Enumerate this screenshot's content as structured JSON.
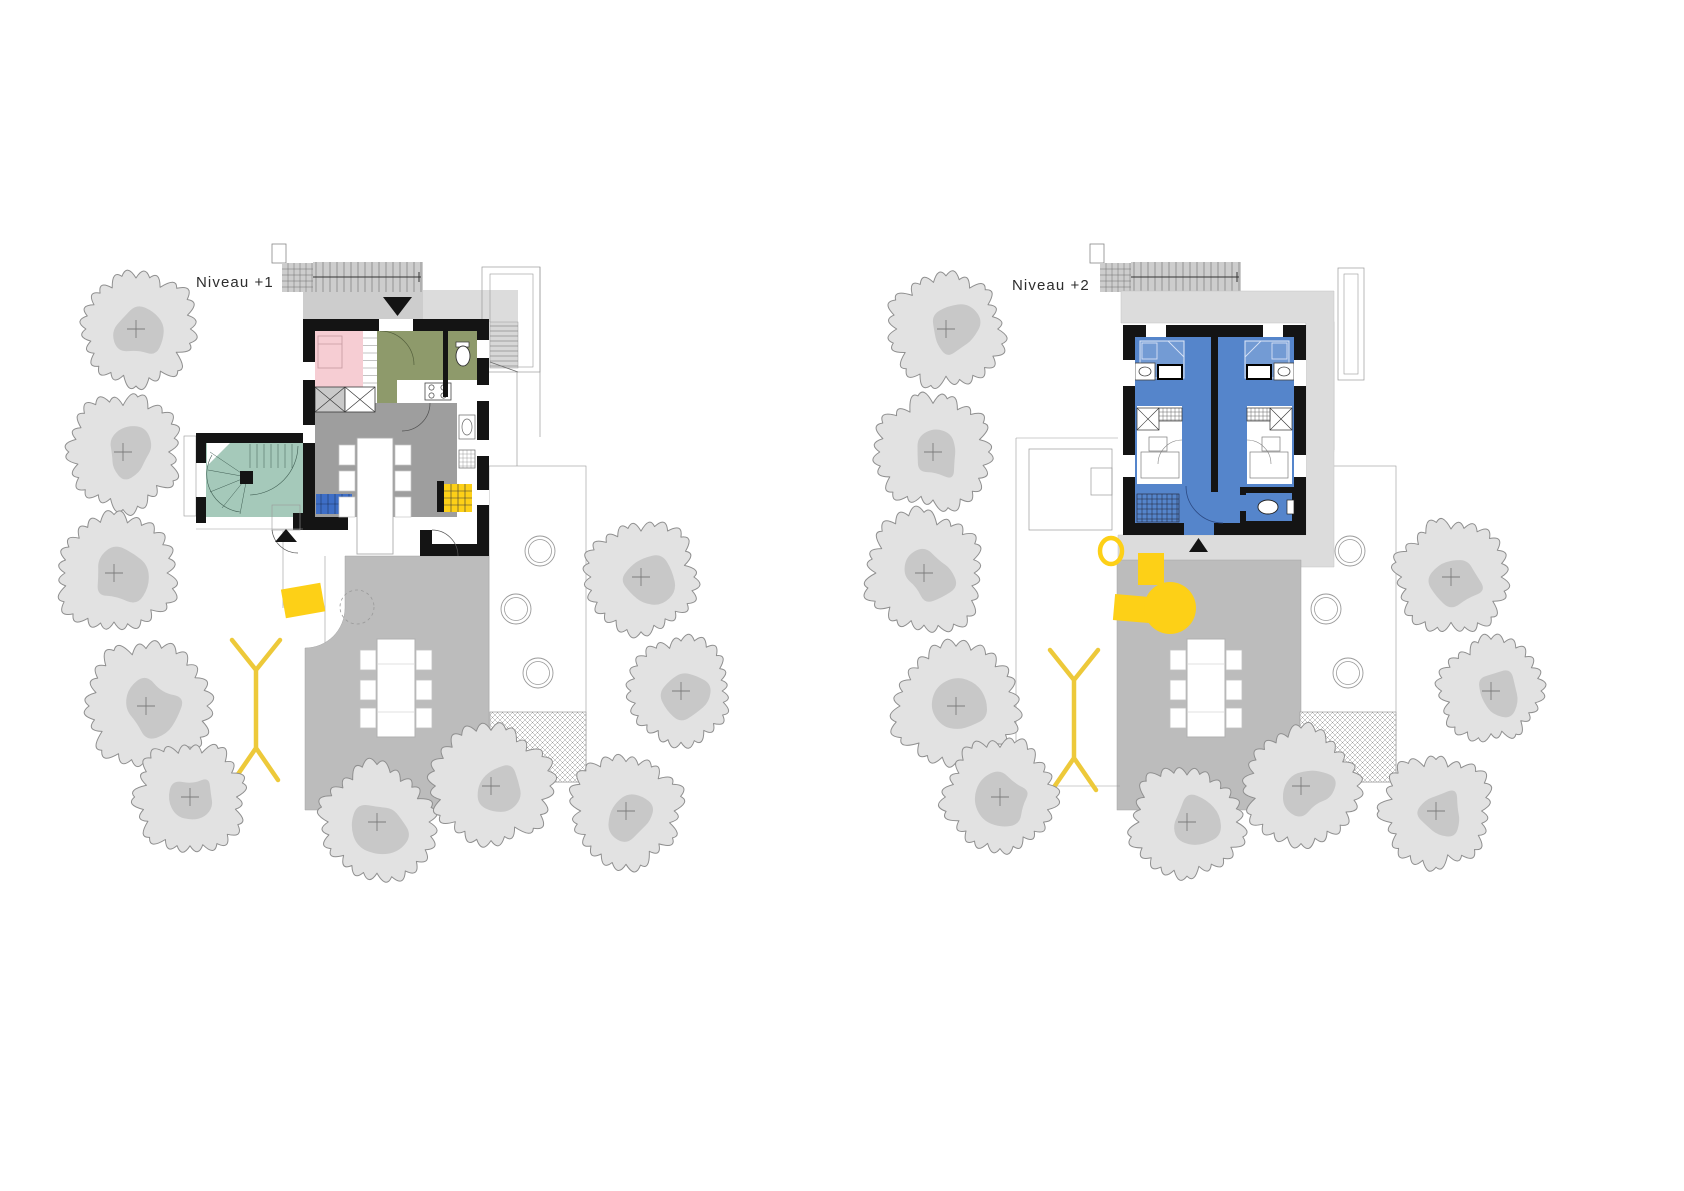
{
  "page": {
    "width": 1684,
    "height": 1191,
    "background": "#ffffff"
  },
  "plans": [
    {
      "name": "niveau-plus-1",
      "label": "Niveau +1",
      "label_x": 196,
      "label_y": 287,
      "offset_x": 0,
      "variant": "level1"
    },
    {
      "name": "niveau-plus-2",
      "label": "Niveau +2",
      "label_x": 1012,
      "label_y": 290,
      "offset_x": 810,
      "variant": "level2"
    }
  ],
  "colors": {
    "wall": "#141414",
    "pink": "#f6cdd3",
    "olive": "#8e9a6b",
    "living_gray": "#9e9e9e",
    "teal": "#a5c9ba",
    "bedroom_blue": "#5585cb",
    "sofa_blue": "#3e6ec6",
    "accent_yellow": "#fdd017",
    "clothesline_yellow": "#edc93a",
    "terrace_gray": "#bcbcbc",
    "deck_gray": "#dcdcdc",
    "stair_gray": "#cdcdcd",
    "stair_light": "#d7d7d7",
    "tree_fill": "#e2e2e2",
    "tree_shadow": "#c8c8c8",
    "tree_stroke": "#8f8f8f",
    "thin_line": "#9a9a9a",
    "detail_line": "#555555"
  },
  "site": {
    "trees": [
      {
        "cx": 136,
        "cy": 329,
        "r": 58
      },
      {
        "cx": 123,
        "cy": 452,
        "r": 57
      },
      {
        "cx": 114,
        "cy": 573,
        "r": 60
      },
      {
        "cx": 146,
        "cy": 706,
        "r": 63
      },
      {
        "cx": 190,
        "cy": 797,
        "r": 56
      },
      {
        "cx": 377,
        "cy": 822,
        "r": 57
      },
      {
        "cx": 491,
        "cy": 786,
        "r": 59
      },
      {
        "cx": 626,
        "cy": 811,
        "r": 56
      },
      {
        "cx": 641,
        "cy": 577,
        "r": 56
      },
      {
        "cx": 681,
        "cy": 691,
        "r": 51
      }
    ],
    "stepping_stones": [
      {
        "cx": 540,
        "cy": 551,
        "r": 15
      },
      {
        "cx": 516,
        "cy": 609,
        "r": 15
      },
      {
        "cx": 538,
        "cy": 673,
        "r": 15
      }
    ],
    "terrace": {
      "x": 305,
      "y": 556,
      "w": 184,
      "h": 254
    },
    "hatch_square": {
      "x": 490,
      "y": 712,
      "w": 96,
      "h": 70
    },
    "garden_strip": {
      "x": 489,
      "y": 466,
      "w": 97,
      "h": 316
    }
  }
}
